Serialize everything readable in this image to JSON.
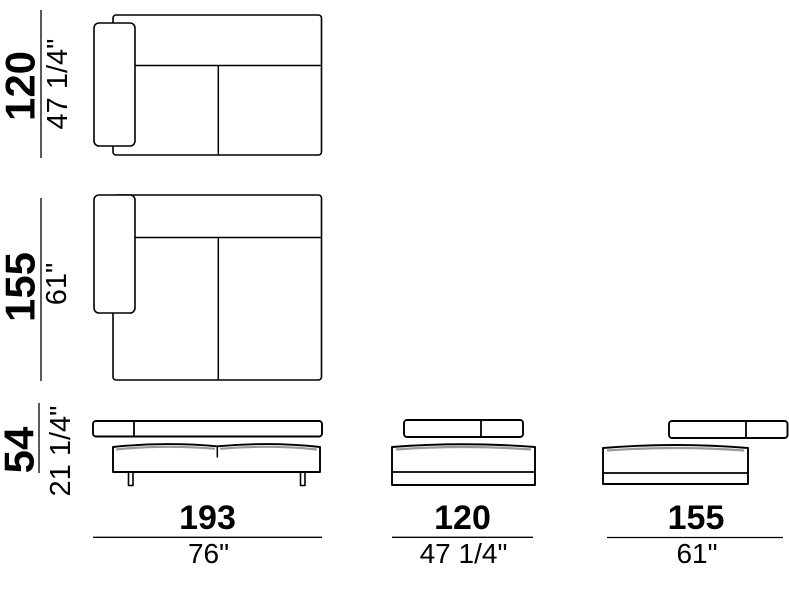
{
  "figure": {
    "background": "#ffffff",
    "line_color": "#000000",
    "shade_color": "#999999"
  },
  "dimensions": {
    "plan_top_depth": {
      "cm": "120",
      "inches": "47 1/4\""
    },
    "plan_middle_depth": {
      "cm": "155",
      "inches": "61\""
    },
    "elevation_height": {
      "cm": "54",
      "inches": "21 1/4\""
    },
    "elevation_left_width": {
      "cm": "193",
      "inches": "76\""
    },
    "elevation_middle_width": {
      "cm": "120",
      "inches": "47 1/4\""
    },
    "elevation_right_width": {
      "cm": "155",
      "inches": "61\""
    }
  }
}
